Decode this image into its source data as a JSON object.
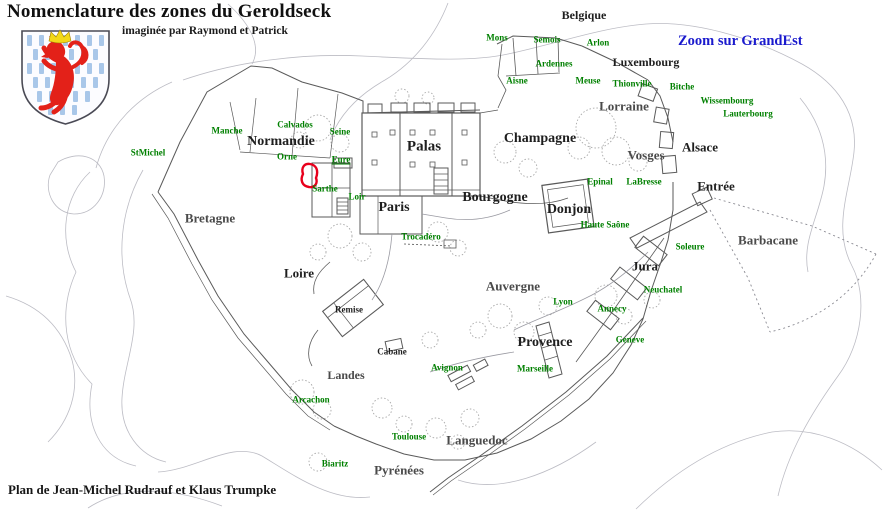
{
  "header": {
    "title": "Nomenclature des zones du Geroldseck",
    "subtitle": "imaginée par Raymond et Patrick"
  },
  "link": {
    "label": "Zoom sur GrandEst"
  },
  "footer": {
    "credit": "Plan de Jean-Michel Rudrauf et Klaus Trumpke"
  },
  "colors": {
    "region_text": "#1e1e1e",
    "region_text_muted": "#4a4a4a",
    "place_text": "#008000",
    "link_text": "#1a1acd",
    "highlight_red": "#e8001c",
    "wall_line": "#5a5a5a",
    "contour_line": "#bcbcc4",
    "shield_field": "#fcfcff",
    "shield_stripe_blue": "#a9c7e9",
    "lion_red": "#e32119",
    "crown_yellow": "#f3d818"
  },
  "icons": {
    "coat_of_arms": "lion-rampant-shield"
  },
  "map": {
    "region_labels": [
      {
        "text": "Belgique",
        "x": 584,
        "y": 15,
        "size": 12
      },
      {
        "text": "Luxembourg",
        "x": 646,
        "y": 62,
        "size": 12
      },
      {
        "text": "Lorraine",
        "x": 624,
        "y": 106,
        "size": 13,
        "muted": true
      },
      {
        "text": "Normandie",
        "x": 281,
        "y": 142,
        "size": 14
      },
      {
        "text": "Palas",
        "x": 424,
        "y": 147,
        "size": 15
      },
      {
        "text": "Champagne",
        "x": 540,
        "y": 139,
        "size": 14
      },
      {
        "text": "Vosges",
        "x": 646,
        "y": 155,
        "size": 13,
        "muted": true
      },
      {
        "text": "Alsace",
        "x": 700,
        "y": 147,
        "size": 13
      },
      {
        "text": "Entrée",
        "x": 716,
        "y": 186,
        "size": 13
      },
      {
        "text": "Bretagne",
        "x": 210,
        "y": 218,
        "size": 13,
        "muted": true
      },
      {
        "text": "Paris",
        "x": 394,
        "y": 208,
        "size": 14
      },
      {
        "text": "Bourgogne",
        "x": 495,
        "y": 198,
        "size": 14
      },
      {
        "text": "Donjon",
        "x": 569,
        "y": 210,
        "size": 14
      },
      {
        "text": "Barbacane",
        "x": 768,
        "y": 240,
        "size": 13,
        "muted": true
      },
      {
        "text": "Jura",
        "x": 645,
        "y": 266,
        "size": 13
      },
      {
        "text": "Loire",
        "x": 299,
        "y": 273,
        "size": 13
      },
      {
        "text": "Auvergne",
        "x": 513,
        "y": 286,
        "size": 13,
        "muted": true
      },
      {
        "text": "Provence",
        "x": 545,
        "y": 343,
        "size": 14
      },
      {
        "text": "Landes",
        "x": 346,
        "y": 375,
        "size": 12,
        "muted": true
      },
      {
        "text": "Languedoc",
        "x": 477,
        "y": 440,
        "size": 13,
        "muted": true
      },
      {
        "text": "Pyrénées",
        "x": 399,
        "y": 470,
        "size": 13,
        "muted": true
      },
      {
        "text": "Remise",
        "x": 349,
        "y": 310,
        "size": 9
      },
      {
        "text": "Cabane",
        "x": 392,
        "y": 352,
        "size": 9
      }
    ],
    "place_labels": [
      {
        "text": "Mons",
        "x": 497,
        "y": 38
      },
      {
        "text": "Semois",
        "x": 547,
        "y": 40
      },
      {
        "text": "Arlon",
        "x": 598,
        "y": 43
      },
      {
        "text": "Ardennes",
        "x": 554,
        "y": 64
      },
      {
        "text": "Aisne",
        "x": 517,
        "y": 81
      },
      {
        "text": "Meuse",
        "x": 588,
        "y": 81
      },
      {
        "text": "Thionville",
        "x": 632,
        "y": 84
      },
      {
        "text": "Bitche",
        "x": 682,
        "y": 87
      },
      {
        "text": "Wissembourg",
        "x": 727,
        "y": 101
      },
      {
        "text": "Lauterbourg",
        "x": 748,
        "y": 114
      },
      {
        "text": "StMichel",
        "x": 148,
        "y": 153
      },
      {
        "text": "Manche",
        "x": 227,
        "y": 131
      },
      {
        "text": "Calvados",
        "x": 295,
        "y": 125
      },
      {
        "text": "Seine",
        "x": 340,
        "y": 132
      },
      {
        "text": "Orne",
        "x": 287,
        "y": 157
      },
      {
        "text": "Eure",
        "x": 341,
        "y": 160,
        "underline": true
      },
      {
        "text": "Sarthe",
        "x": 325,
        "y": 189
      },
      {
        "text": "Loir",
        "x": 357,
        "y": 197
      },
      {
        "text": "Trocadéro",
        "x": 421,
        "y": 237
      },
      {
        "text": "Epinal",
        "x": 600,
        "y": 182
      },
      {
        "text": "LaBresse",
        "x": 644,
        "y": 182
      },
      {
        "text": "Haute Saône",
        "x": 605,
        "y": 225
      },
      {
        "text": "Soleure",
        "x": 690,
        "y": 247
      },
      {
        "text": "Neuchatel",
        "x": 663,
        "y": 290
      },
      {
        "text": "Lyon",
        "x": 563,
        "y": 302
      },
      {
        "text": "Annecy",
        "x": 612,
        "y": 309
      },
      {
        "text": "Geneve",
        "x": 630,
        "y": 340
      },
      {
        "text": "Avignon",
        "x": 447,
        "y": 368
      },
      {
        "text": "Marseille",
        "x": 535,
        "y": 369
      },
      {
        "text": "Arcachon",
        "x": 311,
        "y": 400
      },
      {
        "text": "Toulouse",
        "x": 409,
        "y": 437
      },
      {
        "text": "Biaritz",
        "x": 335,
        "y": 464
      }
    ]
  }
}
